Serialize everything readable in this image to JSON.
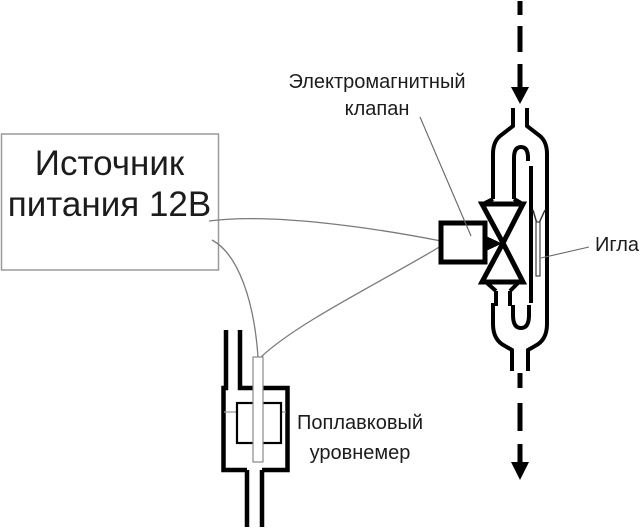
{
  "labels": {
    "power_supply": {
      "line1": "Источник",
      "line2": "питания 12В"
    },
    "solenoid_valve": {
      "line1": "Электромагнитный",
      "line2": "клапан"
    },
    "needle": "Игла",
    "float_gauge": {
      "line1": "Поплавковый",
      "line2": "уровнемер"
    }
  },
  "colors": {
    "ink": "#000000",
    "wire": "#7a7a7a",
    "leader": "#666666",
    "box_border": "#9a9a9a",
    "text": "#1c1c1c"
  }
}
